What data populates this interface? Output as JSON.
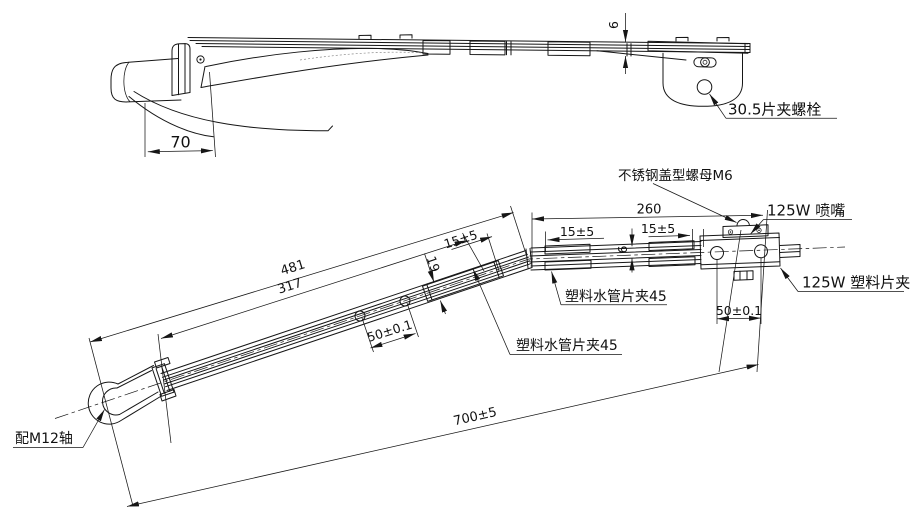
{
  "colors": {
    "line": "#161616",
    "background": "#ffffff",
    "text": "#111111"
  },
  "top_view": {
    "dim_thickness_6": "6",
    "dim_width_70": "70",
    "label_clip_bolt": "30.5片夹螺栓"
  },
  "main_view": {
    "dim_481": "481",
    "dim_317": "317",
    "dim_overall": "700±5",
    "dim_260": "260",
    "dim_width_19": "19",
    "dim_tube_6": "6",
    "dim_hole_pitch_1": "50±0.1",
    "dim_hole_pitch_2": "50±0.1",
    "dim_15_1": "15±5",
    "dim_15_2": "15±5",
    "dim_15_3": "15±5",
    "label_shaft": "配M12轴",
    "label_tube_clip_lower": "塑料水管片夹45",
    "label_tube_clip_upper": "塑料水管片夹45",
    "label_cap_nut": "不锈钢盖型螺母M6",
    "label_nozzle": "125W 喷嘴",
    "label_plastic_clip": "125W 塑料片夹"
  }
}
